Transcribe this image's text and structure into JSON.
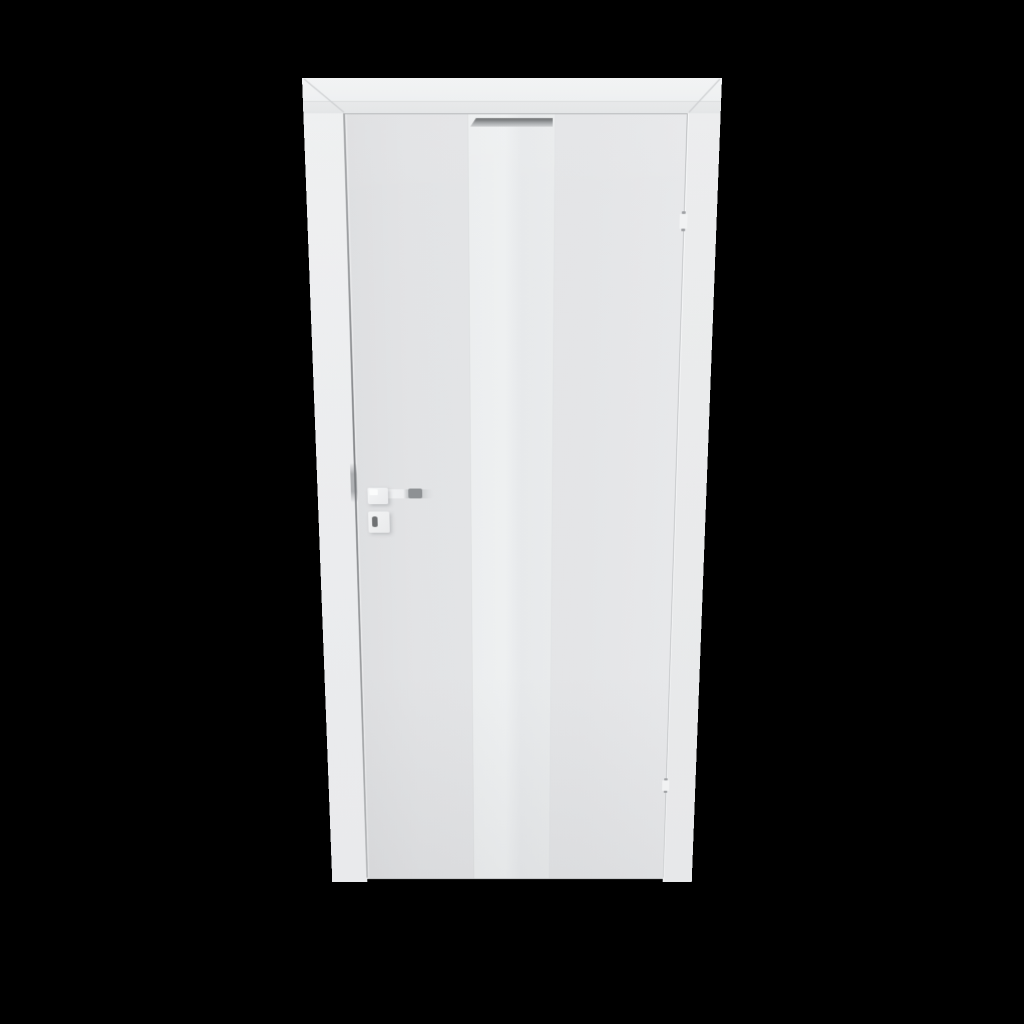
{
  "scene": {
    "type": "3d-product-render",
    "subject": "Closed white interior door in frame, viewed in perspective on a black background",
    "background_color": "#000000",
    "palette": {
      "frame": "#EFF0F1",
      "door_leaf": "#E3E4E6",
      "glass_stripe": "#ECEEEF",
      "aluminium_trim": "#96999C",
      "handle_metal": "#8E9194",
      "keyhole": "#6F7173",
      "gap_shadow": "#85878A"
    },
    "parts": {
      "frame_header": "Door frame head with mitred architrave corners",
      "frame_jamb_left": "Left frame jamb",
      "frame_jamb_right": "Right frame jamb",
      "door_leaf": "Flush white door leaf",
      "glass_stripe": "Central vertical frosted-glass stripe",
      "aluminium_trim": "Grey aluminium trim at top of glass stripe",
      "handle": "Square-rosette lever handle on left side",
      "escutcheon": "Key escutcheon with keyhole below handle",
      "hinges": "Two hinge cut-outs in the right-hand gap",
      "latch": "Latch strike shadow in the left-hand gap"
    },
    "hinge_count": 2
  }
}
